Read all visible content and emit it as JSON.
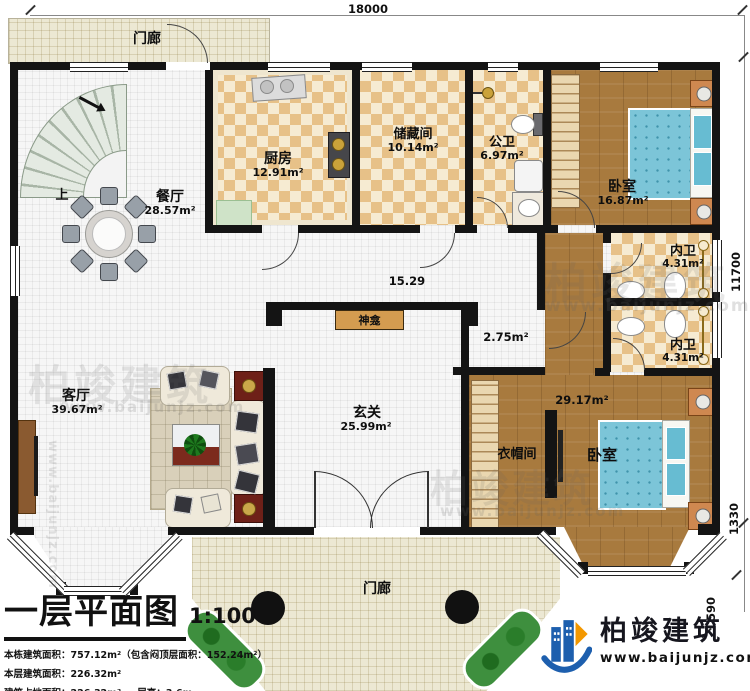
{
  "plan": {
    "dim_top": "18000",
    "dim_right_main": "11700",
    "dim_right_bay": "1330",
    "dim_right_small": "590"
  },
  "rooms": {
    "porch_top": {
      "name": "门廊"
    },
    "porch_bottom": {
      "name": "门廊"
    },
    "dining": {
      "name": "餐厅",
      "area": "28.57m²"
    },
    "kitchen": {
      "name": "厨房",
      "area": "12.91m²"
    },
    "storage": {
      "name": "储藏间",
      "area": "10.14m²"
    },
    "public_bath": {
      "name": "公卫",
      "area": "6.97m²"
    },
    "bedroom_top": {
      "name": "卧室",
      "area": "16.87m²"
    },
    "ensuite_upper": {
      "name": "内卫",
      "area": "4.31m²"
    },
    "ensuite_lower": {
      "name": "内卫",
      "area": "4.31m²"
    },
    "living": {
      "name": "客厅",
      "area": "39.67m²"
    },
    "foyer": {
      "name": "玄关",
      "area": "25.99m²"
    },
    "cloakroom": {
      "name": "衣帽间"
    },
    "bedroom_bottom": {
      "name": "卧室",
      "area": "29.17m²"
    },
    "corridor": {
      "area": "15.29"
    },
    "inner_hall": {
      "area": "2.75m²"
    },
    "stairs": {
      "label": "上"
    },
    "shrine": {
      "label": "神龛"
    }
  },
  "titleblock": {
    "title": "一层平面图",
    "scale": "1:100",
    "stat1": "本栋建筑面积：757.12m²（包含闷顶层面积：152.24m²）",
    "stat2": "本层建筑面积：226.32m²",
    "stat3": "建筑占地面积：226.32m²",
    "stat4": "层高：3.6m"
  },
  "brand": {
    "name": "柏竣建筑",
    "url": "www.baijunjz.com",
    "blue": "#1d5fae",
    "orange": "#f39800"
  },
  "watermark": {
    "name": "柏竣建筑",
    "url": "www.baijunjz.com"
  }
}
